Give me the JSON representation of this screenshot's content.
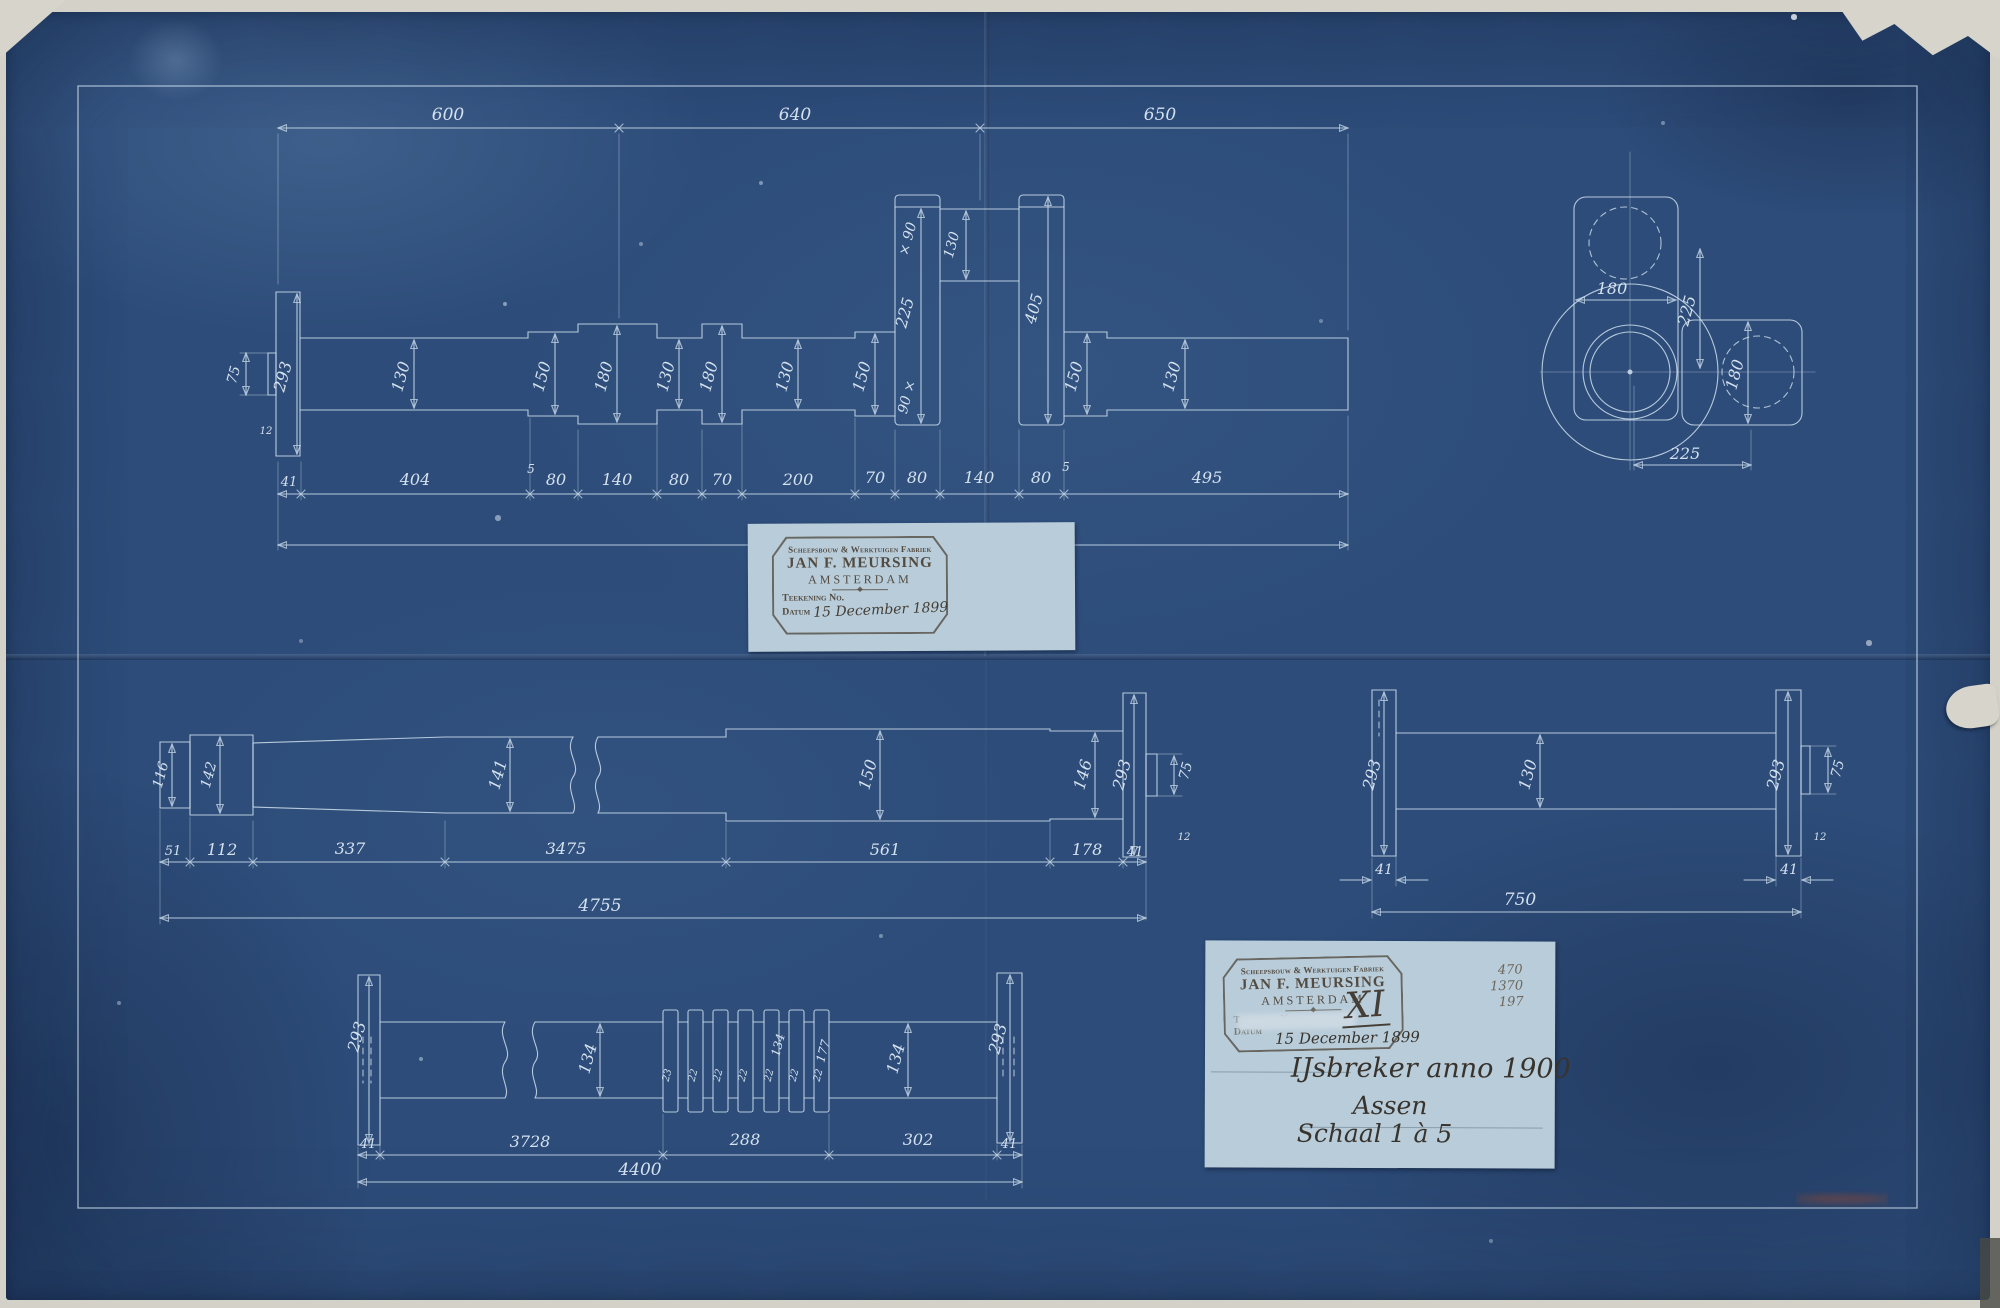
{
  "stamp": {
    "factory_line": "Scheepsbouw & Werktuigen Fabriek",
    "company": "JAN F. MEURSING",
    "city": "AMSTERDAM",
    "drawing_no_label": "Teekening No.",
    "date_label": "Datum",
    "date": "15 December 1899"
  },
  "title_block": {
    "stamp_number": "XI",
    "corner_notes": [
      "470",
      "1370",
      "197"
    ],
    "date": "15 December 1899",
    "subject": "IJsbreker anno 1900",
    "part": "Assen",
    "scale": "Schaal 1 à 5"
  },
  "crankshaft": {
    "top_dims": [
      "600",
      "640",
      "650"
    ],
    "bottom_dims": [
      "41",
      "404",
      "5",
      "80",
      "140",
      "80",
      "70",
      "200",
      "70",
      "80",
      "140",
      "80",
      "5",
      "495"
    ],
    "total": "1890",
    "stub_dia": "75",
    "stub_step": "12",
    "flange_dia": "293",
    "dia_labels": [
      "130",
      "150",
      "180",
      "130",
      "180",
      "130",
      "150",
      "150",
      "130"
    ],
    "crank_web_dim_a": "× 90",
    "crank_web_dim_b": "225",
    "crank_web_dim_c": "90 ×",
    "crank_pin_dia": "130",
    "crank_web_right": "405"
  },
  "end_view": {
    "web_width": "180",
    "pin_dia": "180",
    "throw": "225",
    "offset": "225"
  },
  "intermediate_shaft": {
    "dims": [
      "51",
      "112",
      "337",
      "3475",
      "561",
      "178",
      "41"
    ],
    "total": "4755",
    "dia_labels": [
      "116",
      "142",
      "141",
      "150",
      "146",
      "293",
      "75",
      "12"
    ]
  },
  "coupling_shaft": {
    "flange_width_left": "41",
    "flange_width_right": "41",
    "total": "750",
    "dia_labels": [
      "293",
      "130",
      "293",
      "75",
      "12"
    ]
  },
  "grooved_shaft": {
    "dims": [
      "41",
      "3728",
      "288",
      "302",
      "41"
    ],
    "total": "4400",
    "dia_labels": [
      "293",
      "134",
      "134",
      "293"
    ],
    "ring_root": "134",
    "ring_od": "177",
    "ring_dims": [
      "23",
      "22",
      "22",
      "22",
      "22",
      "22",
      "22"
    ]
  }
}
